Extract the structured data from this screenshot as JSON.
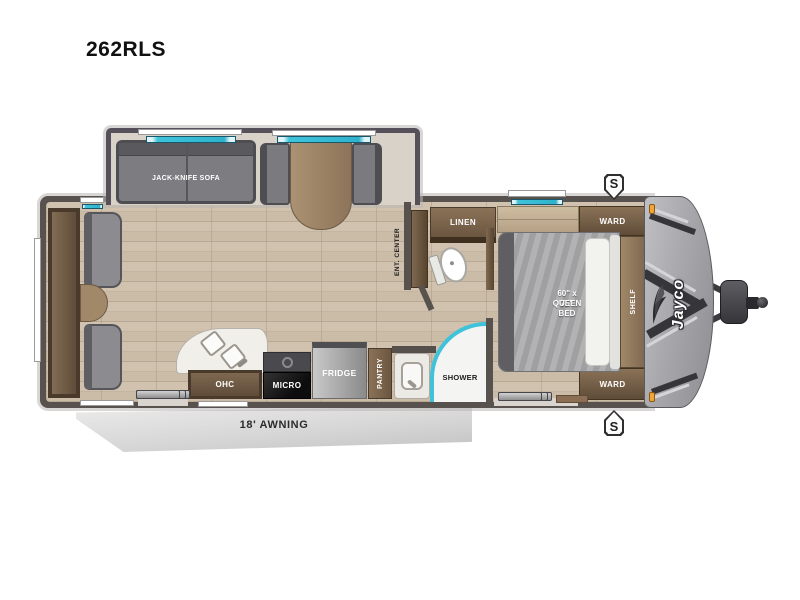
{
  "model": "262RLS",
  "brand_logo": "Jayco",
  "labels": {
    "sofa": "JACK-KNIFE SOFA",
    "rear_ohc": "OHC",
    "kitchen_ohc": "OHC",
    "micro": "MICRO",
    "fridge": "FRIDGE",
    "pantry": "PANTRY",
    "ent_center": "ENT. CENTER",
    "linen": "LINEN",
    "shower": "SHOWER",
    "bed_size": "60\" x 75\"",
    "bed_type": "QUEEN BED",
    "ward_front": "WARD",
    "ward_rear": "WARD",
    "shelf": "SHELF",
    "awning": "18' AWNING",
    "speaker": "S"
  },
  "colors": {
    "wall": "#57524d",
    "floor": "#cbbca8",
    "window_glass": "#3fc3da",
    "front_cap": "#a8a8ac",
    "marker_light": "#f2a535",
    "cabinet": "#6b5640"
  }
}
